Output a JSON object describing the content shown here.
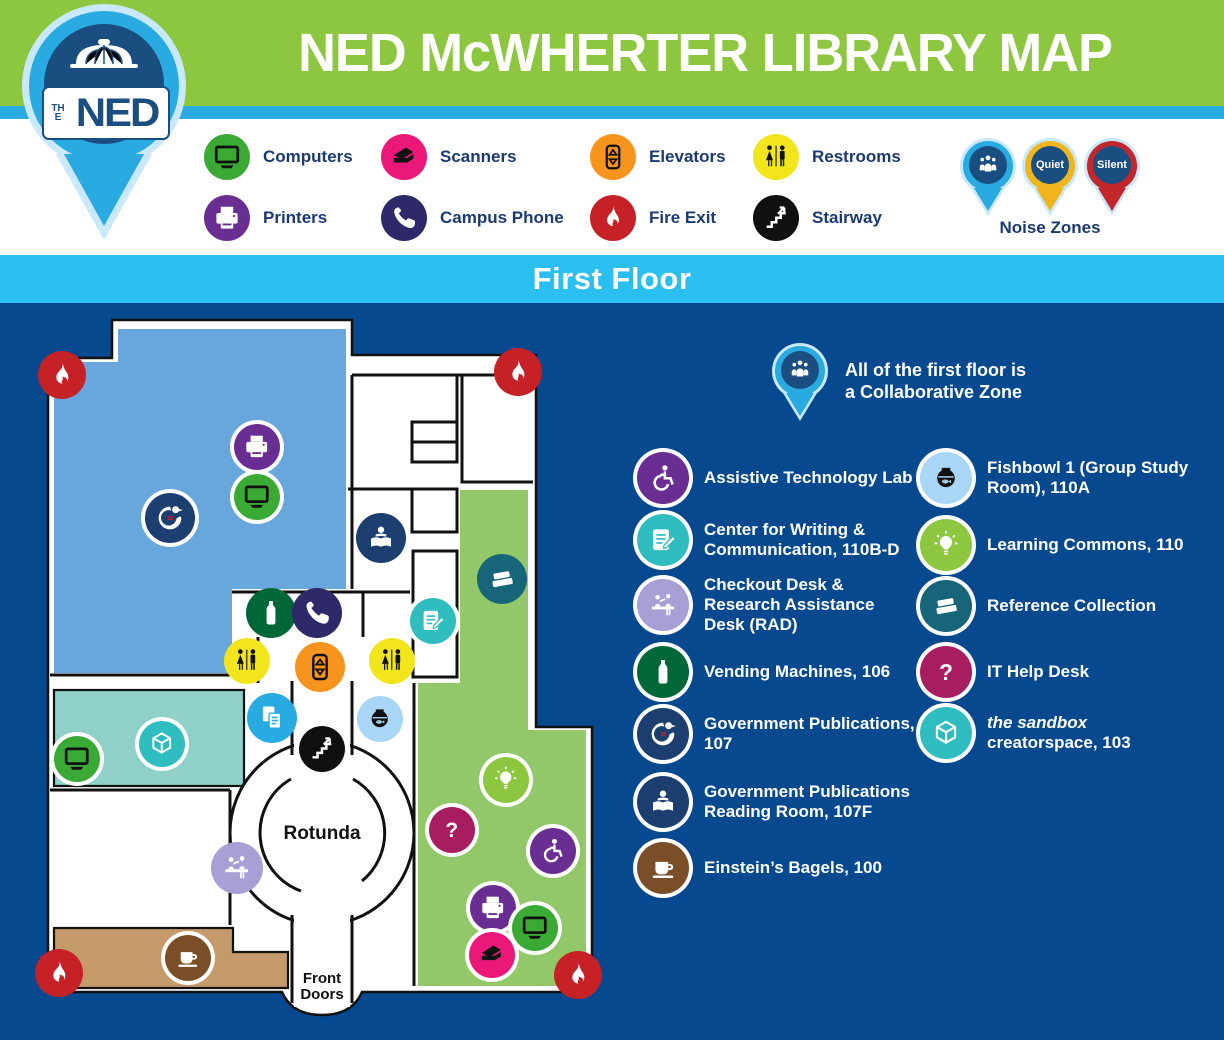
{
  "header": {
    "title": "NED McWHERTER LIBRARY MAP"
  },
  "logo": {
    "the": "THE",
    "ned": "NED"
  },
  "floor": {
    "label": "First Floor"
  },
  "legend": {
    "items": [
      {
        "icon": "computers-icon",
        "label": "Computers"
      },
      {
        "icon": "printers-icon",
        "label": "Printers"
      },
      {
        "icon": "scanners-icon",
        "label": "Scanners"
      },
      {
        "icon": "campus-phone-icon",
        "label": "Campus Phone"
      },
      {
        "icon": "elevators-icon",
        "label": "Elevators"
      },
      {
        "icon": "fire-exit-icon",
        "label": "Fire Exit"
      },
      {
        "icon": "restrooms-icon",
        "label": "Restrooms"
      },
      {
        "icon": "stairway-icon",
        "label": "Stairway"
      }
    ]
  },
  "noise": {
    "title": "Noise Zones",
    "pins": [
      {
        "name": "collaborative-zone-pin",
        "color": "#29ABE2",
        "label": ""
      },
      {
        "name": "quiet-zone-pin",
        "color": "#F0B51D",
        "label": "Quiet"
      },
      {
        "name": "silent-zone-pin",
        "color": "#C1272D",
        "label": "Silent"
      }
    ]
  },
  "map": {
    "rotunda_label": "Rotunda",
    "front_doors_label": "Front Doors",
    "collab_note": [
      "All of the first floor is",
      "a Collaborative Zone"
    ],
    "markers": [
      {
        "name": "fire-exit-icon",
        "glyph": "flame",
        "cls": "red",
        "x": 62,
        "y": 72,
        "d": 48
      },
      {
        "name": "fire-exit-icon",
        "glyph": "flame",
        "cls": "red",
        "x": 518,
        "y": 69,
        "d": 48
      },
      {
        "name": "fire-exit-icon",
        "glyph": "flame",
        "cls": "red",
        "x": 59,
        "y": 670,
        "d": 48
      },
      {
        "name": "fire-exit-icon",
        "glyph": "flame",
        "cls": "red",
        "x": 578,
        "y": 672,
        "d": 48
      },
      {
        "name": "printer-icon",
        "glyph": "printer",
        "cls": "purple",
        "x": 257,
        "y": 144,
        "ring": true
      },
      {
        "name": "computer-icon",
        "glyph": "computer",
        "cls": "green",
        "x": 257,
        "y": 194,
        "ring": true
      },
      {
        "name": "government-publications-icon",
        "glyph": "eagle",
        "cls": "navy",
        "x": 170,
        "y": 215,
        "ring": true,
        "d": 50
      },
      {
        "name": "reading-room-icon",
        "glyph": "reader",
        "cls": "navy",
        "x": 381,
        "y": 235,
        "d": 50
      },
      {
        "name": "reference-collection-icon",
        "glyph": "books",
        "cls": "teal",
        "x": 502,
        "y": 276,
        "d": 50
      },
      {
        "name": "writing-center-icon",
        "glyph": "writing",
        "cls": "cyan",
        "x": 433,
        "y": 318,
        "ring": true
      },
      {
        "name": "vending-machines-icon",
        "glyph": "bottle",
        "cls": "dkgreen",
        "x": 271,
        "y": 310,
        "d": 50
      },
      {
        "name": "campus-phone-icon",
        "glyph": "phone",
        "cls": "indigo",
        "x": 317,
        "y": 310,
        "d": 50
      },
      {
        "name": "restrooms-icon",
        "glyph": "restroom",
        "cls": "yellow",
        "x": 247,
        "y": 358
      },
      {
        "name": "restrooms-icon",
        "glyph": "restroom",
        "cls": "yellow",
        "x": 392,
        "y": 358
      },
      {
        "name": "elevators-icon",
        "glyph": "elevator",
        "cls": "orange",
        "x": 320,
        "y": 364,
        "d": 50
      },
      {
        "name": "photocopier-icon",
        "glyph": "copier",
        "cls": "blue",
        "x": 272,
        "y": 415,
        "d": 50
      },
      {
        "name": "fishbowl-icon",
        "glyph": "fishbowl",
        "cls": "paleblue",
        "x": 380,
        "y": 416
      },
      {
        "name": "stairway-icon",
        "glyph": "stairs",
        "cls": "black",
        "x": 322,
        "y": 446,
        "ring": true
      },
      {
        "name": "sandbox-icon",
        "glyph": "cube",
        "cls": "cyan",
        "x": 162,
        "y": 441,
        "ring": true
      },
      {
        "name": "computer-icon",
        "glyph": "computer",
        "cls": "green",
        "x": 77,
        "y": 456,
        "ring": true
      },
      {
        "name": "learning-commons-icon",
        "glyph": "bulb",
        "cls": "lime",
        "x": 506,
        "y": 477,
        "ring": true
      },
      {
        "name": "it-help-desk-icon",
        "glyph": "question",
        "cls": "magenta",
        "x": 452,
        "y": 527,
        "ring": true
      },
      {
        "name": "assistive-technology-icon",
        "glyph": "wheelchair",
        "cls": "purple",
        "x": 553,
        "y": 548,
        "ring": true
      },
      {
        "name": "checkout-desk-icon",
        "glyph": "deskhelp",
        "cls": "lav",
        "x": 237,
        "y": 565,
        "d": 52
      },
      {
        "name": "printer-icon",
        "glyph": "printer",
        "cls": "purple",
        "x": 493,
        "y": 605,
        "ring": true
      },
      {
        "name": "computer-icon",
        "glyph": "computer",
        "cls": "green",
        "x": 535,
        "y": 625,
        "ring": true
      },
      {
        "name": "scanner-icon",
        "glyph": "scanner",
        "cls": "pink",
        "x": 492,
        "y": 652,
        "ring": true
      },
      {
        "name": "einsteins-bagels-icon",
        "glyph": "coffee",
        "cls": "brown",
        "x": 188,
        "y": 655,
        "ring": true
      }
    ]
  },
  "locations": {
    "left": [
      {
        "icon": "assistive-technology-icon",
        "label": "Assistive Technology Lab"
      },
      {
        "icon": "writing-center-icon",
        "label": "Center for Writing & Communication, 110B-D"
      },
      {
        "icon": "checkout-desk-icon",
        "label": "Checkout Desk & Research Assistance Desk (RAD)"
      },
      {
        "icon": "vending-machines-icon",
        "label": "Vending Machines, 106"
      },
      {
        "icon": "government-publications-icon",
        "label": "Government Publications, 107"
      },
      {
        "icon": "reading-room-icon",
        "label": "Government Publications Reading Room, 107F"
      },
      {
        "icon": "einsteins-bagels-icon",
        "label": "Einstein’s Bagels, 100"
      }
    ],
    "right": [
      {
        "icon": "fishbowl-icon",
        "label": "Fishbowl 1 (Group Study Room), 110A"
      },
      {
        "icon": "learning-commons-icon",
        "label": "Learning Commons, 110"
      },
      {
        "icon": "reference-collection-icon",
        "label": "Reference Collection"
      },
      {
        "icon": "it-help-desk-icon",
        "label": "IT Help Desk"
      },
      {
        "icon": "sandbox-icon",
        "label_italic": "the sandbox",
        "label": "creatorspace, 103"
      }
    ]
  },
  "colors": {
    "header_green": "#8DC63F",
    "stripe_blue": "#29ABE2",
    "floor_bar_blue": "#2BBFF0",
    "map_background": "#07498F",
    "gov_pubs_room": "#68A7DB",
    "learning_commons_room": "#92C869",
    "sandbox_room": "#8FD1C8",
    "bagels_room": "#C59A6B",
    "pin_navy": "#1B4E80"
  }
}
